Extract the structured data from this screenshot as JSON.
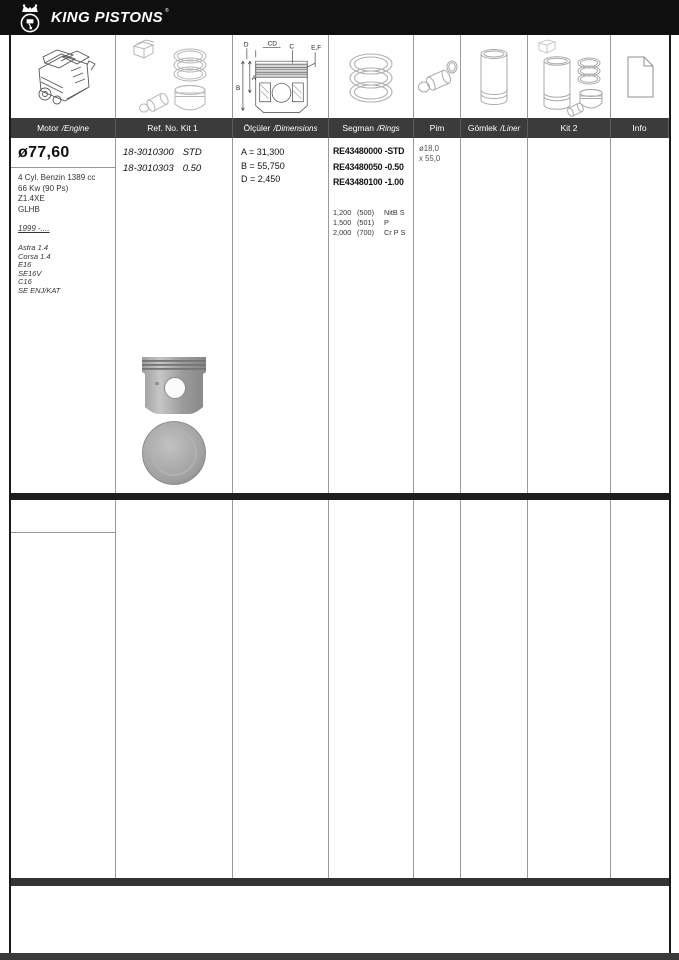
{
  "brand": {
    "name": "KING PISTONS",
    "reg": "®"
  },
  "columns": [
    {
      "main": "Motor",
      "italic": "/Engine"
    },
    {
      "main": "Ref. No. Kit 1",
      "italic": ""
    },
    {
      "main": "Ölçüler",
      "italic": "/Dimensions"
    },
    {
      "main": "Segman",
      "italic": "/Rings"
    },
    {
      "main": "Pim",
      "italic": ""
    },
    {
      "main": "Gömlek",
      "italic": "/Liner"
    },
    {
      "main": "Kit 2",
      "italic": ""
    },
    {
      "main": "Info",
      "italic": ""
    }
  ],
  "icons": [
    "engine-icon",
    "piston-kit-icon",
    "piston-dimensions-icon",
    "rings-icon",
    "pin-icon",
    "liner-icon",
    "kit2-icon",
    "info-icon"
  ],
  "diagram_labels": {
    "d": "D",
    "cd": "CD",
    "c": "C",
    "ef": "E,F",
    "a": "A",
    "b": "B"
  },
  "row": {
    "bore": "ø77,60",
    "engine_lines": [
      "4 Cyl. Benzin 1389 cc",
      "66 Kw (90 Ps)",
      "Z1.4XE",
      "GLHB"
    ],
    "years": "1999 -....",
    "models": [
      "Astra 1.4",
      "Corsa 1.4",
      "E16",
      "SE16V",
      "C16",
      "SE ENJ/KAT"
    ],
    "kit1_refs": [
      {
        "no": "18-3010300",
        "size": "STD"
      },
      {
        "no": "18-3010303",
        "size": "0.50"
      }
    ],
    "dimensions": [
      "A = 31,300",
      "B = 55,750",
      "D = 2,450"
    ],
    "ring_refs": [
      "RE43480000 -STD",
      "RE43480050 -0.50",
      "RE43480100 -1.00"
    ],
    "ring_specs": [
      {
        "height": "1,200",
        "code": "(500)",
        "type": "NitB S"
      },
      {
        "height": "1,500",
        "code": "(501)",
        "type": "P"
      },
      {
        "height": "2,000",
        "code": "(700)",
        "type": "Cr P S"
      }
    ],
    "pin": {
      "diameter": "ø18,0",
      "length": "x 55,0"
    }
  },
  "colors": {
    "topbar": "#0f0f0f",
    "header_row": "#3b3b3b",
    "divider": "#1d1d1d",
    "grid_line": "#9a9a9a"
  }
}
